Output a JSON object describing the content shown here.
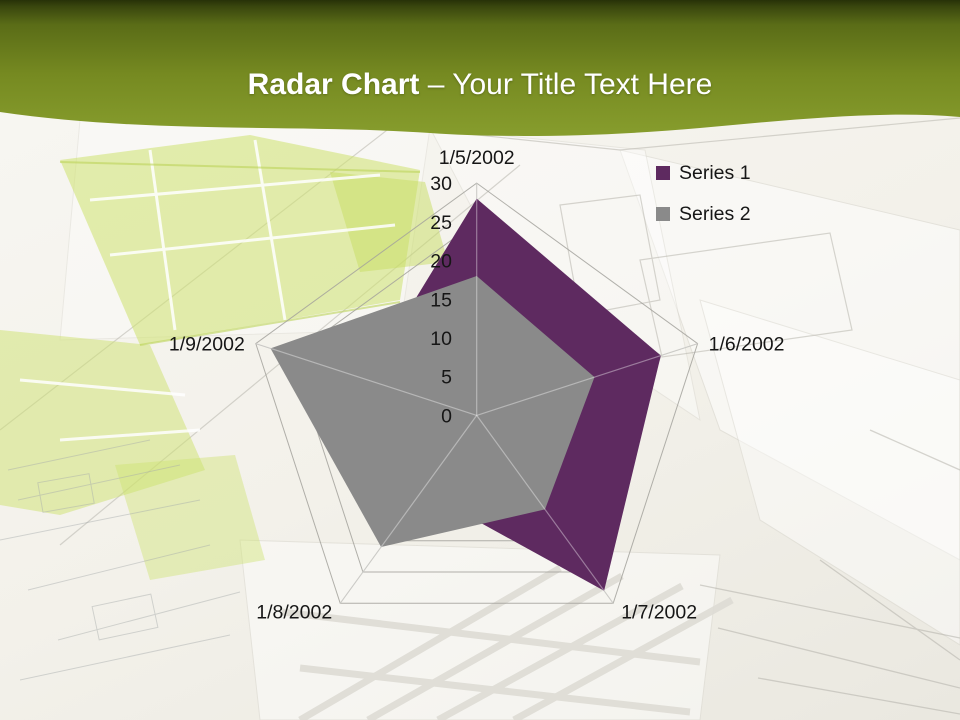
{
  "slide": {
    "title": {
      "bold": "Radar Chart",
      "rest": " – Your Title Text Here"
    }
  },
  "theme": {
    "header_green_dark": "#273108",
    "header_green": "#7a8f22",
    "header_green_light": "#879d2d",
    "background_cream": "#f3f1ea",
    "lime_accent": "#cde26e",
    "series1_purple": "#5E2A60",
    "series2_gray": "#8A8A8A",
    "grid_line": "#a3a29c",
    "label_text": "#161616"
  },
  "chart_data": {
    "type": "radar",
    "title": "",
    "categories": [
      "1/5/2002",
      "1/6/2002",
      "1/7/2002",
      "1/8/2002",
      "1/9/2002"
    ],
    "series": [
      {
        "name": "Series 1",
        "color": "#5E2A60",
        "values": [
          28,
          25,
          28,
          12,
          15
        ]
      },
      {
        "name": "Series 2",
        "color": "#8A8A8A",
        "values": [
          18,
          16,
          15,
          21,
          28
        ]
      }
    ],
    "radial_axis": {
      "min": 0,
      "max": 30,
      "step": 5,
      "tick_labels": [
        "0",
        "5",
        "10",
        "15",
        "20",
        "25",
        "30"
      ]
    },
    "legend": {
      "position": "top-right",
      "entries": [
        "Series 1",
        "Series 2"
      ]
    },
    "grid": {
      "rings": true,
      "spokes": true
    }
  }
}
